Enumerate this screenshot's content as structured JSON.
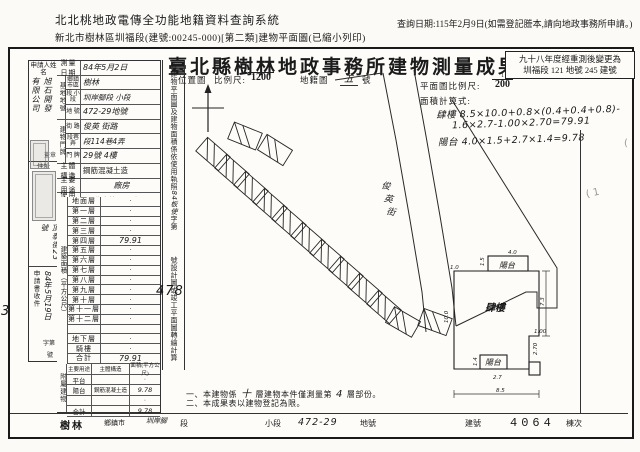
{
  "header": {
    "system_title": "北北桃地政電傳全功能地籍資料查詢系統",
    "print_info": "新北市樹林區圳福段(建號:00245-000)[第二類]建物平面圖(已縮小列印)",
    "query_date": "查詢日期:115年2月9日(如需登記謄本,請向地政事務所申請。)"
  },
  "document": {
    "title": "臺北縣樹林地政事務所建物測量成果圖",
    "remeasure_line1": "九十八年度經重測後變更為",
    "remeasure_line2": "圳福段 121 地號 245 建號"
  },
  "margin": {
    "signature": "蔡明旭",
    "receipt_number": "3209",
    "faint_mark_1": "( 1",
    "faint_mark_2": "("
  },
  "applicant": {
    "name_label": "申請人姓名",
    "name_col_right": "旭石開發",
    "name_col_left": "有限公司",
    "seal_note": "蓋章",
    "address_label": "住址",
    "address_value": "頂泰街23號",
    "receipt_label": "申請書收件",
    "receipt_date": "84年5月19日",
    "receipt_no_prefix": "字第",
    "receipt_no_suffix": "號"
  },
  "survey": {
    "date_label": "測量日期",
    "date_value": "84年5月2日",
    "site_group": "基地地號",
    "town_label": "鄉鎮市區",
    "town_value": "樹林",
    "section_label": "段 小段",
    "section_value": "圳岸腳段 小段",
    "lot_label": "地 號",
    "lot_value": "472-29地號",
    "bldg_group": "建物門牌",
    "street_label": "街 路",
    "street_value": "俊英 街路",
    "lane_label": "段巷弄",
    "lane_value": "段114巷4弄",
    "door_label": "門 牌",
    "door_value": "29號 4樓",
    "structure_label": "主體構造",
    "structure_value": "鋼筋混凝土造",
    "usage_label": "主要用途",
    "usage_value": "廠房",
    "license_label": "使用執照",
    "license_value": "84使字第478號"
  },
  "area_table": {
    "group_label": "建築面積（平方公尺）",
    "floors": [
      {
        "label": "地面層",
        "value": "·",
        "hand": false
      },
      {
        "label": "第一層",
        "value": "·",
        "hand": false
      },
      {
        "label": "第二層",
        "value": "·",
        "hand": false
      },
      {
        "label": "第三層",
        "value": "·",
        "hand": false
      },
      {
        "label": "第四層",
        "value": "79.91",
        "hand": true
      },
      {
        "label": "第五層",
        "value": "·",
        "hand": false
      },
      {
        "label": "第六層",
        "value": "·",
        "hand": false
      },
      {
        "label": "第七層",
        "value": "·",
        "hand": false
      },
      {
        "label": "第八層",
        "value": "·",
        "hand": false
      },
      {
        "label": "第九層",
        "value": "·",
        "hand": false
      },
      {
        "label": "第十層",
        "value": "·",
        "hand": false
      },
      {
        "label": "第十一層",
        "value": "·",
        "hand": false
      },
      {
        "label": "第十二層",
        "value": "·",
        "hand": false
      },
      {
        "label": "",
        "value": "",
        "hand": false
      },
      {
        "label": "地下層",
        "value": "·",
        "hand": false
      },
      {
        "label": "騎樓",
        "value": "·",
        "hand": false
      },
      {
        "label": "合計",
        "value": "79.91",
        "hand": true
      }
    ]
  },
  "attached_table": {
    "group_label": "附屬建物",
    "col_usage": "主要用途",
    "col_structure": "主體構造",
    "col_area": "面積(平方公尺)",
    "rows": [
      {
        "usage": "平台",
        "structure": "",
        "area": "·",
        "hand": false
      },
      {
        "usage": "陽台",
        "structure": "鋼筋混凝土造",
        "area": "9.78",
        "hand": true
      },
      {
        "usage": "",
        "structure": "",
        "area": "·",
        "hand": false
      },
      {
        "usage": "合計",
        "structure": "",
        "area": "9.78",
        "hand": true
      }
    ]
  },
  "vertical_note": {
    "part1": "本建物平面圖及建物面積係依使用執照",
    "hand1": "84板使",
    "part2": "字第",
    "hand2": "478",
    "part3": "號設計圖或竣工平面圖轉繪計算"
  },
  "location_map": {
    "section_label": "位置圖",
    "scale_label": "比例尺:",
    "scale_numerator": "1",
    "scale_denominator": "1200",
    "sheet_prefix": "地籍圖",
    "sheet_no": "五",
    "sheet_suffix": "號",
    "street_name": "俊英街"
  },
  "floor_plan": {
    "scale_label": "平面圖比例尺:",
    "scale_numerator": "1",
    "scale_denominator": "200",
    "formula_label": "面積計算式:",
    "formula_line1": "肆樓 8.5×10.0+0.8×(0.4+0.4+0.8)-",
    "formula_line2": "1.6×2.7-1.00×2.70=79.91",
    "formula_line3": "陽台 4.0×1.5+2.7×1.4=9.78",
    "room_label": "肆樓",
    "balcony_top": "陽台",
    "balcony_bottom": "陽台",
    "dims": [
      {
        "t": "4.0",
        "x": 68,
        "y": 6,
        "r": 0
      },
      {
        "t": "1.5",
        "x": 44,
        "y": 18,
        "r": -90
      },
      {
        "t": "1.0",
        "x": 10,
        "y": 21,
        "r": 0
      },
      {
        "t": "10.0",
        "x": 8,
        "y": 75,
        "r": -90
      },
      {
        "t": "7.3",
        "x": 104,
        "y": 58,
        "r": -90
      },
      {
        "t": "1.00",
        "x": 94,
        "y": 85,
        "r": 0
      },
      {
        "t": "2.70",
        "x": 97,
        "y": 107,
        "r": -90
      },
      {
        "t": "1.4",
        "x": 37,
        "y": 118,
        "r": -90
      },
      {
        "t": "2.7",
        "x": 53,
        "y": 131,
        "r": 0
      },
      {
        "t": "8.5",
        "x": 56,
        "y": 144,
        "r": 0
      }
    ]
  },
  "notes": {
    "line1_a": "一、本建物係",
    "line1_hand1": "十",
    "line1_b": "層建物本件僅測量第",
    "line1_hand2": "4",
    "line1_c": "層部份。",
    "line2": "二、本成果表以建物登記為限。"
  },
  "bottom_strip": {
    "town": "樹林",
    "town_suffix": "鄉鎮市",
    "section_hand": "圳岸腳",
    "section_suffix": "段",
    "subsection": "小段",
    "lot_hand": "472-29",
    "lot_suffix": "地號",
    "bldg_label": "建號",
    "bldg_no": "4064",
    "bldg_unit": "棟次"
  }
}
